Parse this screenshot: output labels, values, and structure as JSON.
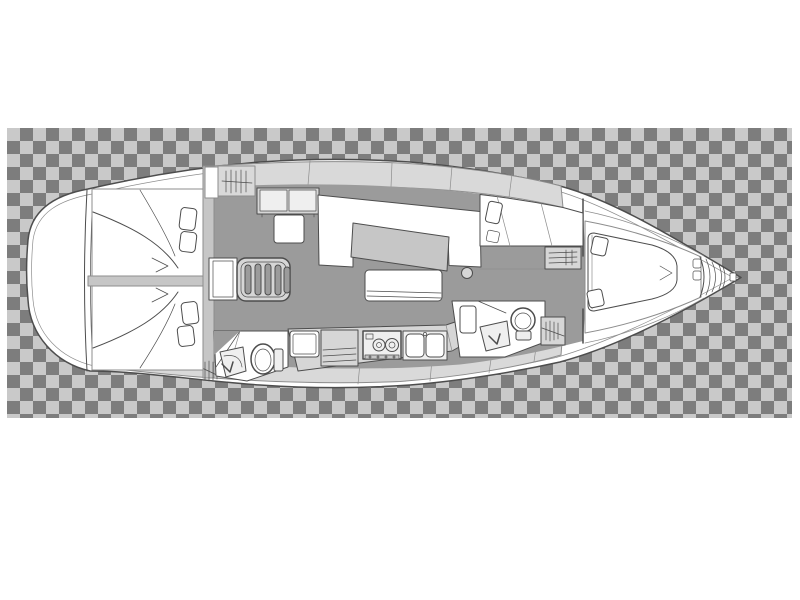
{
  "canvas": {
    "width": 800,
    "height": 600,
    "background": "#ffffff"
  },
  "checkerboard": {
    "x": 7,
    "y": 128,
    "width": 785,
    "height": 290,
    "square_px": 13,
    "dark": "#7d7d7d",
    "light": "#c9c9c9",
    "meaning": "transparency-checker-backdrop"
  },
  "palette": {
    "line": "#4d4d4d",
    "line-soft": "#8d8d8d",
    "hull": "#ffffff",
    "floor": "#9b9b9b",
    "deck": "#d9d9d9",
    "furn": "#d6d6d6",
    "furn-dark": "#c6c6c6"
  },
  "floorplan": {
    "subject": "sailing-yacht-interior-deck-plan",
    "view": "top-down",
    "bow_direction": "right",
    "text_labels": [],
    "compartments": [
      {
        "id": "stern-platform",
        "fixtures": []
      },
      {
        "id": "aft-cabin-top",
        "fixtures": [
          "double-berth",
          "pillow",
          "pillow"
        ]
      },
      {
        "id": "aft-cabin-bottom",
        "fixtures": [
          "double-berth",
          "pillow",
          "pillow",
          "hanging-locker-hatch"
        ]
      },
      {
        "id": "aft-head",
        "fixtures": [
          "toilet",
          "washbasin-with-faucet",
          "door"
        ]
      },
      {
        "id": "companionway",
        "fixtures": [
          "five-tread-steps",
          "engine-box"
        ]
      },
      {
        "id": "salon",
        "fixtures": [
          "hanging-locker-hatch",
          "two-door-cabinet",
          "seat-module",
          "u-shaped-settee",
          "dining-table",
          "bench-seat",
          "mast-post"
        ]
      },
      {
        "id": "galley",
        "fixtures": [
          "icebox-module",
          "shelf-cabinet",
          "two-burner-stove",
          "double-sink",
          "counter"
        ]
      },
      {
        "id": "forward-seat-area",
        "fixtures": [
          "seat",
          "cushion",
          "shelf-cabinet-hatched"
        ]
      },
      {
        "id": "forward-head",
        "fixtures": [
          "toilet",
          "washbasin-with-faucet",
          "shelf",
          "hanging-locker-hatch",
          "door"
        ]
      },
      {
        "id": "forward-cabin",
        "fixtures": [
          "island-double-berth",
          "side-shelf",
          "side-shelf"
        ]
      },
      {
        "id": "bow",
        "fixtures": [
          "anchor-locker",
          "stem-fitting"
        ]
      }
    ]
  }
}
